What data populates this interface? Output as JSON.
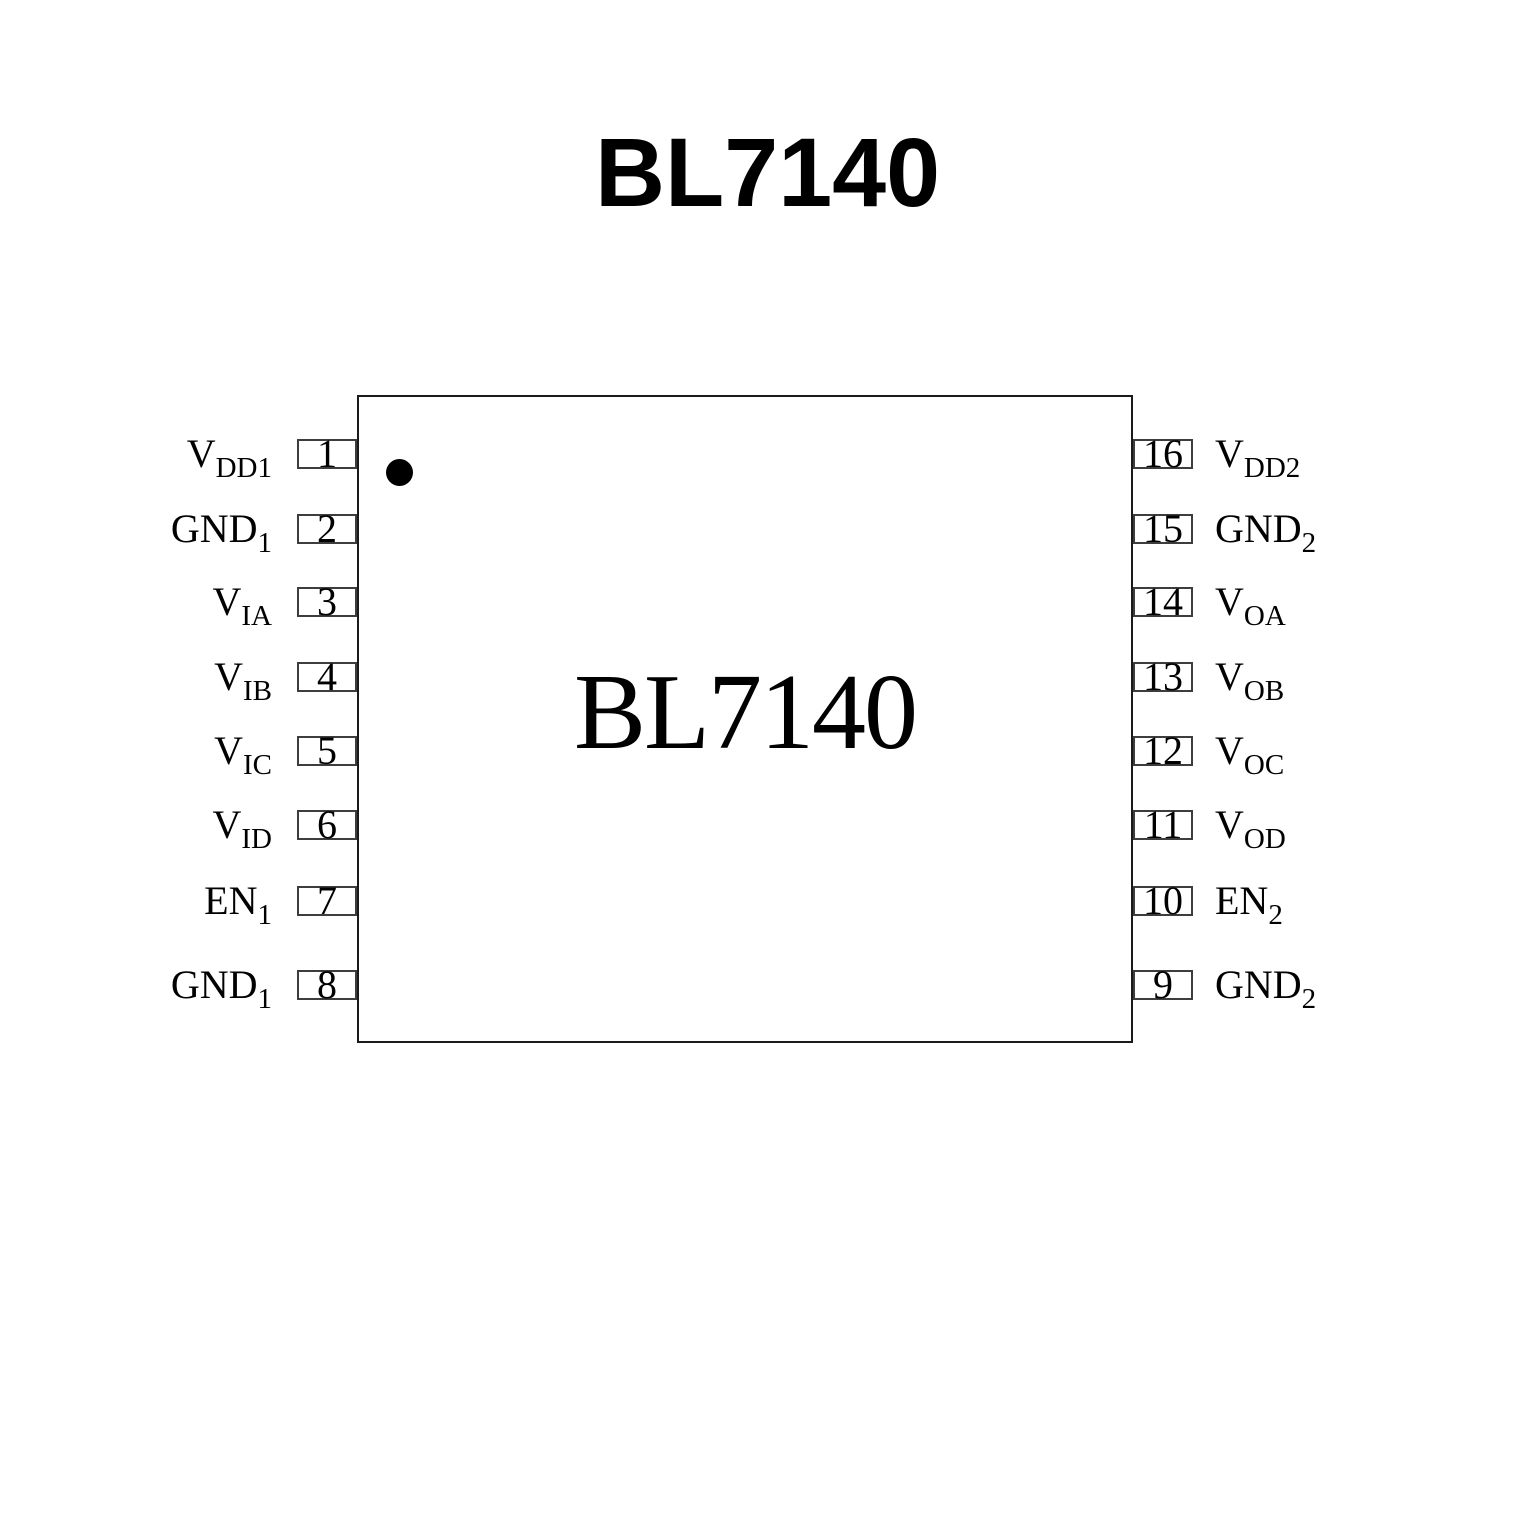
{
  "title": "BL7140",
  "chip": {
    "label": "BL7140"
  },
  "pins": {
    "left": [
      {
        "number": "1",
        "base": "V",
        "sub": "DD1"
      },
      {
        "number": "2",
        "base": "GND",
        "sub": "1"
      },
      {
        "number": "3",
        "base": "V",
        "sub": "IA"
      },
      {
        "number": "4",
        "base": "V",
        "sub": "IB"
      },
      {
        "number": "5",
        "base": "V",
        "sub": "IC"
      },
      {
        "number": "6",
        "base": "V",
        "sub": "ID"
      },
      {
        "number": "7",
        "base": "EN",
        "sub": "1"
      },
      {
        "number": "8",
        "base": "GND",
        "sub": "1"
      }
    ],
    "right": [
      {
        "number": "16",
        "base": "V",
        "sub": "DD2"
      },
      {
        "number": "15",
        "base": "GND",
        "sub": "2"
      },
      {
        "number": "14",
        "base": "V",
        "sub": "OA"
      },
      {
        "number": "13",
        "base": "V",
        "sub": "OB"
      },
      {
        "number": "12",
        "base": "V",
        "sub": "OC"
      },
      {
        "number": "11",
        "base": "V",
        "sub": "OD"
      },
      {
        "number": "10",
        "base": "EN",
        "sub": "2"
      },
      {
        "number": "9",
        "base": "GND",
        "sub": "2"
      }
    ]
  }
}
